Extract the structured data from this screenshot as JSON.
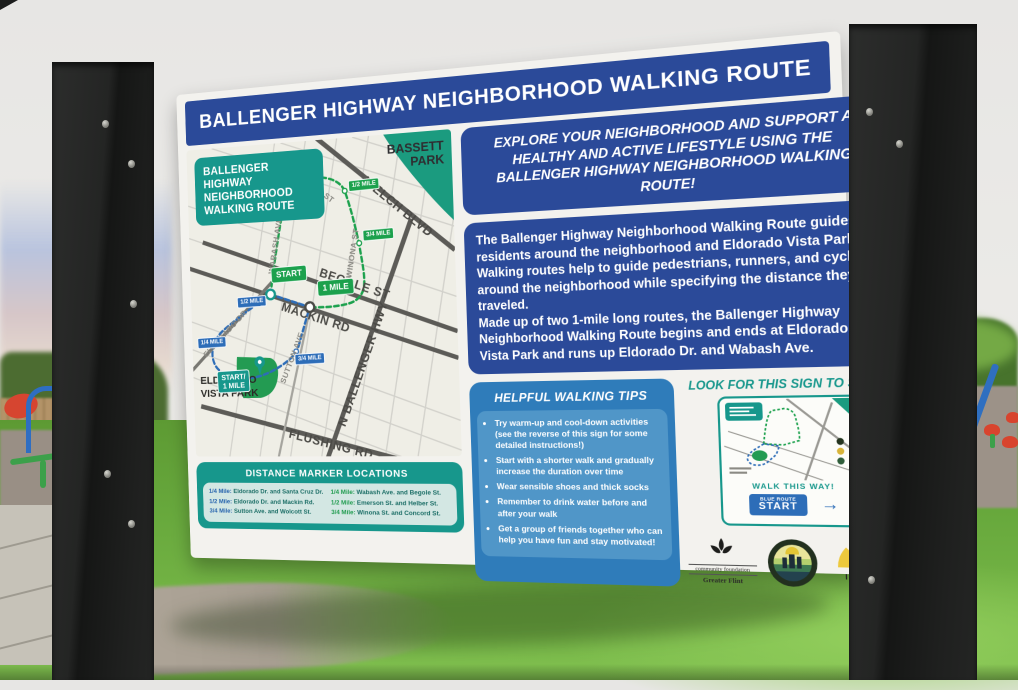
{
  "sign": {
    "title": "BALLENGER HIGHWAY NEIGHBORHOOD WALKING ROUTE",
    "map": {
      "legend": [
        "BALLENGER",
        "HIGHWAY",
        "NEIGHBORHOOD",
        "WALKING ROUTE"
      ],
      "streets": {
        "welch": "WELCH BLVD",
        "begole": "BEGOLE ST",
        "mackin": "MACKIN RD",
        "flushing": "FLUSHING RD",
        "ballenger": "N BALLENGER HWY",
        "eldorado_dr": "ELDORADO DR",
        "wabash": "WABASH AVE",
        "emerson": "EMERSON ST",
        "winona": "WINONA ST",
        "sutton": "SUTTON AVE"
      },
      "parks": {
        "bassett_l1": "BASSETT",
        "bassett_l2": "PARK",
        "eldorado_l1": "ELDORADO",
        "eldorado_l2": "VISTA PARK"
      },
      "markers": {
        "quarter": "1/4 MILE",
        "half": "1/2 MILE",
        "three_quarter": "3/4 MILE",
        "start": "START",
        "one_mile": "1 MILE",
        "start_one_mile_l1": "START/",
        "start_one_mile_l2": "1 MILE"
      }
    },
    "distance": {
      "title": "DISTANCE MARKER LOCATIONS",
      "blue": [
        {
          "label": "1/4 Mile:",
          "text": "Eldorado Dr. and Santa Cruz Dr."
        },
        {
          "label": "1/2 Mile:",
          "text": "Eldorado Dr. and Mackin Rd."
        },
        {
          "label": "3/4 Mile:",
          "text": "Sutton Ave. and Wolcott St."
        }
      ],
      "green": [
        {
          "label": "1/4 Mile:",
          "text": "Wabash Ave. and Begole St."
        },
        {
          "label": "1/2 Mile:",
          "text": "Emerson St. and Helber St."
        },
        {
          "label": "3/4 Mile:",
          "text": "Winona St. and Concord St."
        }
      ]
    },
    "explore": "EXPLORE YOUR NEIGHBORHOOD AND SUPPORT A HEALTHY AND ACTIVE LIFESTYLE USING THE BALLENGER HIGHWAY NEIGHBORHOOD WALKING ROUTE!",
    "description": [
      "The Ballenger Highway Neighborhood Walking Route guides residents around the neighborhood and Eldorado Vista Park.",
      "Walking routes help to guide pedestrians, runners, and cyclists around the neighborhood while specifying the distance they've traveled.",
      "Made up of two 1-mile long routes, the Ballenger Highway Neighborhood Walking Route begins and ends at Eldorado Vista Park and runs up Eldorado Dr. and Wabash Ave."
    ],
    "tips": {
      "title": "HELPFUL WALKING TIPS",
      "items": [
        "Try warm-up and cool-down activities (see the reverse of this sign for some detailed instructions!)",
        "Start with a shorter walk and gradually increase the duration over time",
        "Wear sensible shoes and thick socks",
        "Remember to drink water before and after your walk",
        "Get a group of friends together who can help you have fun and stay motivated!"
      ]
    },
    "start_panel": {
      "heading": "LOOK FOR THIS SIGN TO START!",
      "walk_this_way": "WALK THIS WAY!",
      "button_small": "BLUE ROUTE",
      "button": "START",
      "arrow": "→"
    },
    "logos": {
      "cfgf_line1": "community foundation",
      "cfgf_line2": "Greater Flint",
      "imagine": "IMAGINE FLINT"
    },
    "colors": {
      "navy": "#2b4a99",
      "teal": "#17978c",
      "route_green": "#1ca14d",
      "route_blue": "#2d6db8",
      "tips_blue": "#2f7cba",
      "map_paper": "#efeee6"
    }
  }
}
